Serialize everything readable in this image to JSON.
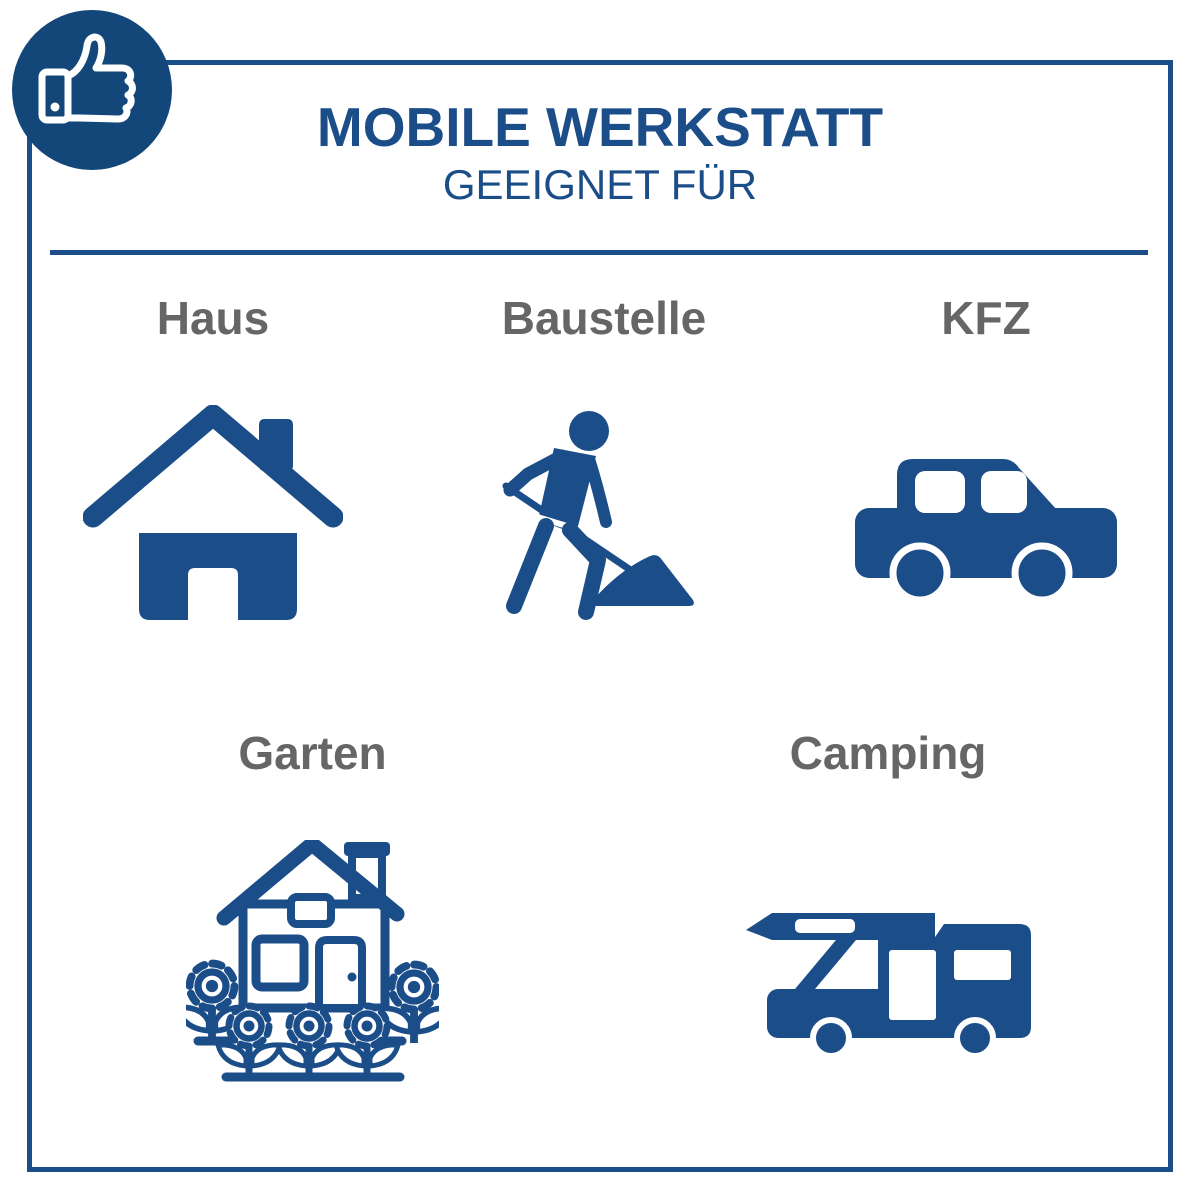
{
  "header": {
    "title": "MOBILE WERKSTATT",
    "subtitle": "GEEIGNET FÜR"
  },
  "badge": {
    "icon": "thumbs-up-icon"
  },
  "items": [
    {
      "label": "Haus",
      "icon": "house-icon"
    },
    {
      "label": "Baustelle",
      "icon": "construction-worker-icon"
    },
    {
      "label": "KFZ",
      "icon": "car-icon"
    },
    {
      "label": "Garten",
      "icon": "garden-house-flowers-icon"
    },
    {
      "label": "Camping",
      "icon": "camper-van-icon"
    }
  ],
  "colors": {
    "primary_blue": "#1b4d88",
    "badge_blue": "#134779",
    "label_gray": "#666666",
    "background": "#ffffff"
  }
}
